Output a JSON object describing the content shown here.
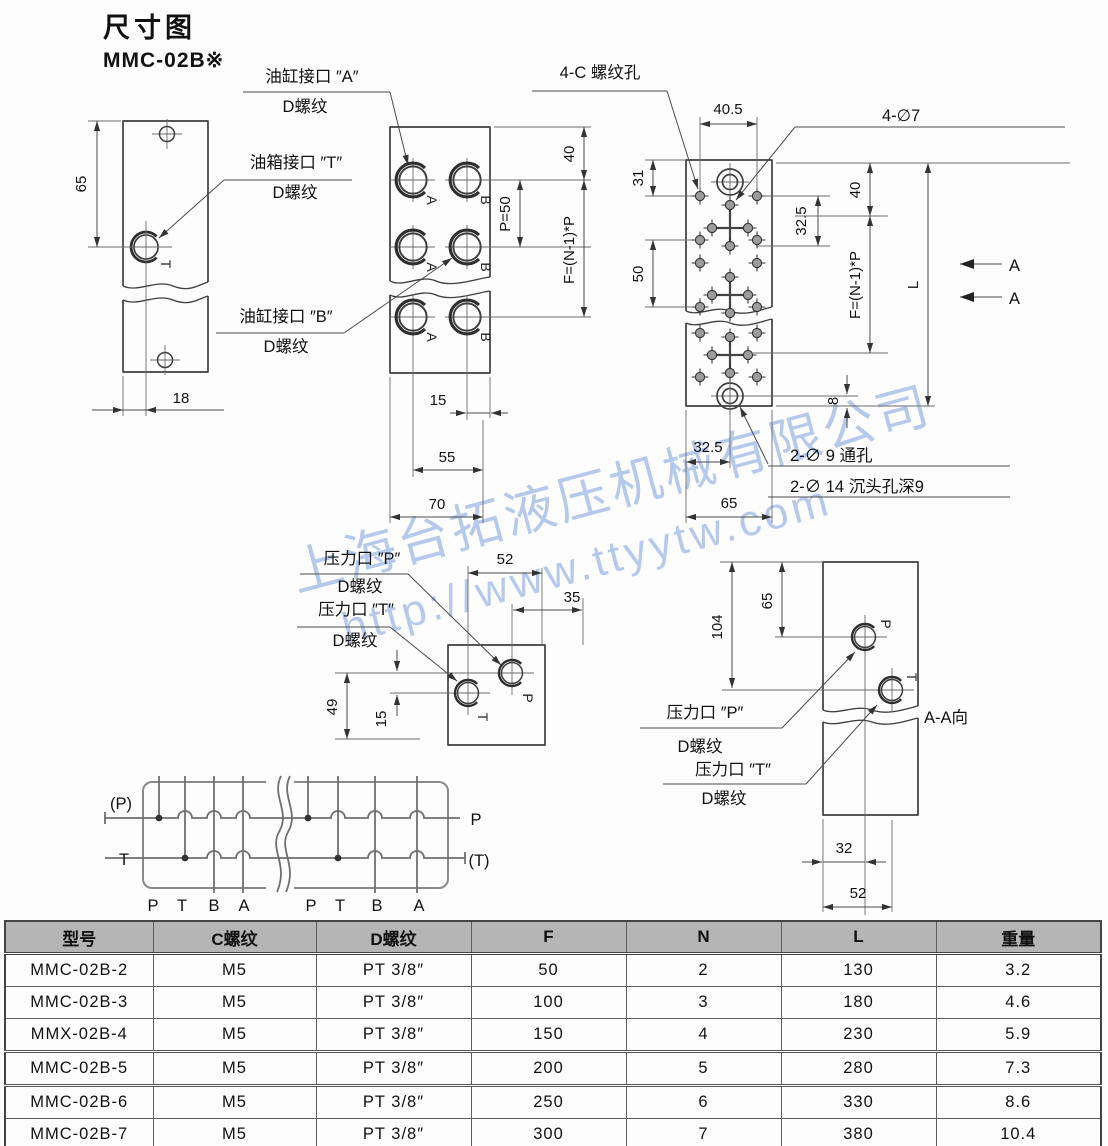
{
  "title": {
    "heading": "尺寸图",
    "model": "MMC-02B※"
  },
  "watermark": {
    "company": "上海台拓液压机械有限公司",
    "url": "http://www.ttyytw.com",
    "color": "#7b9fe0"
  },
  "callouts": {
    "cyl_a": "油缸接口 ″A″",
    "tank_t": "油箱接口 ″T″",
    "cyl_b": "油缸接口 ″B″",
    "thread_d": "D螺纹",
    "tap_holes": "4-C 螺纹孔",
    "drill7": "4-∅7",
    "through9": "2-∅ 9  通孔",
    "cbore14": "2-∅ 14 沉头孔深9",
    "press_p": "压力口 ″P″",
    "press_t": "压力口 ″T″",
    "section_aa": "A-A向",
    "section_arrow": "A"
  },
  "letters": {
    "a": "A",
    "b": "B",
    "p": "P",
    "t": "T"
  },
  "dims": {
    "side_height": "65",
    "side_width": "18",
    "front_top": "40",
    "front_pitch": "P=50",
    "front_f": "F=(N-1)*P",
    "front_15": "15",
    "front_55": "55",
    "front_70": "70",
    "top_405": "40.5",
    "top_31": "31",
    "top_50": "50",
    "top_325": "32.5",
    "top_40": "40",
    "top_f": "F=(N-1)*P",
    "top_len": "L",
    "top_8": "8",
    "bot_325": "32.5",
    "bot_65": "65",
    "pt_52": "52",
    "pt_35": "35",
    "pt_49": "49",
    "pt_15": "15",
    "sec_104": "104",
    "sec_65": "65",
    "sec_32": "32",
    "sec_52": "52"
  },
  "schematic": {
    "left_p": "(P)",
    "left_t": "T",
    "right_p": "P",
    "right_t": "(T)",
    "ports": [
      "P",
      "T",
      "B",
      "A"
    ]
  },
  "table": {
    "headers": [
      "型号",
      "C螺纹",
      "D螺纹",
      "F",
      "N",
      "L",
      "重量"
    ],
    "rows": [
      [
        "MMC-02B-2",
        "M5",
        "PT 3/8″",
        "50",
        "2",
        "130",
        "3.2"
      ],
      [
        "MMC-02B-3",
        "M5",
        "PT 3/8″",
        "100",
        "3",
        "180",
        "4.6"
      ],
      [
        "MMX-02B-4",
        "M5",
        "PT 3/8″",
        "150",
        "4",
        "230",
        "5.9"
      ],
      [
        "MMC-02B-5",
        "M5",
        "PT 3/8″",
        "200",
        "5",
        "280",
        "7.3"
      ],
      [
        "MMC-02B-6",
        "M5",
        "PT 3/8″",
        "250",
        "6",
        "330",
        "8.6"
      ],
      [
        "MMC-02B-7",
        "M5",
        "PT 3/8″",
        "300",
        "7",
        "380",
        "10.4"
      ]
    ]
  }
}
